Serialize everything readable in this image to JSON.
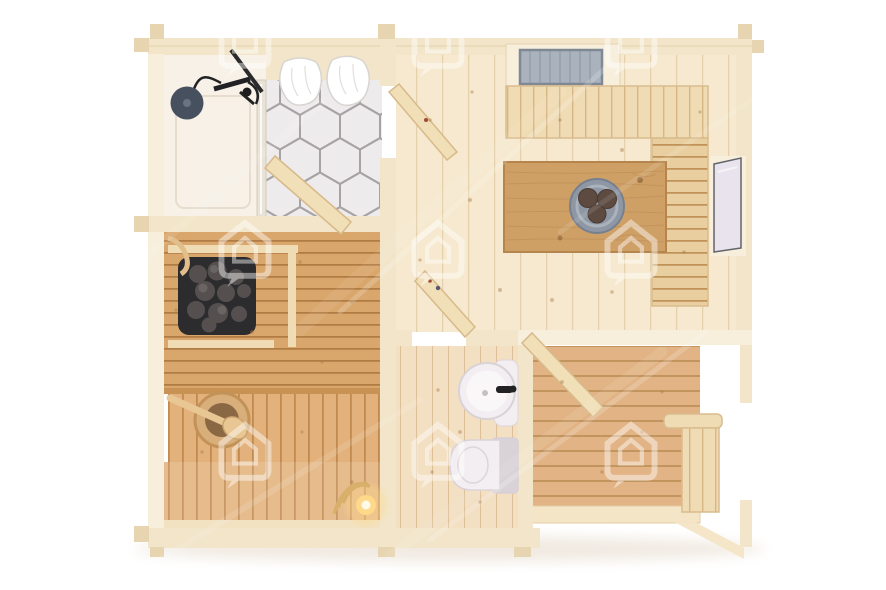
{
  "meta": {
    "title": "Wooden cabin sauna floor plan - top view 3D render",
    "width": 886,
    "height": 590,
    "style": "photoreal top-down architectural render on white background with stock watermarks"
  },
  "palette": {
    "background": "#ffffff",
    "wall": "#f2e5c9",
    "wall_bright": "#f7efdc",
    "wall_shade": "#e7d5b1",
    "floor_light": "#f6e9cf",
    "plank_line": "#e4d1ab",
    "shower_floor": "#f7f1e7",
    "hex_tile": "#eeebec",
    "hex_grout": "#a7a3a5",
    "glass_partition": "#e9e2d6",
    "sauna_bench": "#d9a66c",
    "sauna_gap": "#b17c44",
    "sauna_lower": "#e3b27c",
    "sauna_lower_gap": "#c08a50",
    "bench_light": "#f0dcb4",
    "bench_light_gap": "#d6b684",
    "bench_l": "#e9cf9f",
    "bench_l_gap": "#bf9257",
    "deck": "#e2b485",
    "deck_gap": "#c2945e",
    "bath_floor": "#f3dfc2",
    "bath_plank": "#ddc098",
    "table": "#cfa066",
    "table_grain": "#b0824b",
    "door_leaf": "#f1dfb8",
    "door_edge": "#d8ba8a",
    "heater": "#2c2b2d",
    "stone": "#55504f",
    "stone_light": "#6a6463",
    "shower_head": "#46505e",
    "hose": "#222224",
    "towel": "#ffffff",
    "towel_shade": "#e2dedb",
    "glass_sky": "#a9b2bd",
    "glass_frame": "#7f8893",
    "window_glass": "#e8e3ed",
    "window_frame": "#63636a",
    "porcelain": "#f3eef1",
    "porcelain_shade": "#d9d3d7",
    "bowl": "#8e97a3",
    "bowl_rim": "#aab2bc",
    "fruit": "#5d4a41",
    "bucket": "#d8ae7a",
    "bucket_inner": "#8a6844",
    "ladle": "#e9c795",
    "lantern_glow": "#ffd98a",
    "rope": "#d9b06a",
    "watermark": "#ffffff",
    "knot": "#a97f4e"
  },
  "rooms": {
    "shower": {
      "label": "Shower room with hexagon tile floor"
    },
    "sauna": {
      "label": "Sauna room with tiered wooden benches"
    },
    "hallway": {
      "label": "Hallway with open doors"
    },
    "bathroom": {
      "label": "Bathroom with sink and toilet"
    },
    "living": {
      "label": "Living room with table and wall benches"
    },
    "terrace": {
      "label": "Covered terrace with decking and bench"
    }
  },
  "fixtures": {
    "shower_head": "rainfall shower head",
    "towels": "two white towels on rail",
    "glass_partition": "glass shower partition",
    "sauna_heater": "electric sauna heater with stones",
    "sauna_bucket": "wooden bucket with ladle",
    "wall_hook": "wooden wall hook",
    "lantern": "lit lantern with rope coil",
    "sink": "round washbasin with black tap",
    "toilet": "toilet with cistern",
    "dining_table": "wooden dining table",
    "fruit_bowl": "grey bowl with three fruits",
    "skylight": "roof skylight window",
    "window": "side wall window",
    "terrace_bench": "terrace bench with armrest",
    "doors": "four open door leaves"
  },
  "icons": {
    "watermark": "home-badge-watermark"
  }
}
